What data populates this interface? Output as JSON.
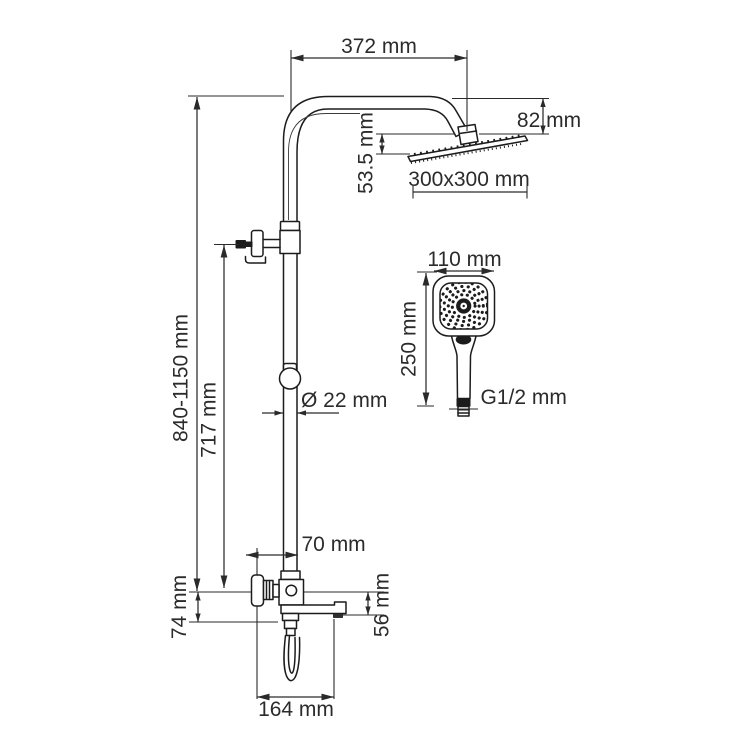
{
  "drawing": {
    "title": "Shower system technical drawing",
    "labels": {
      "arm_reach": "372 mm",
      "head_height": "82 mm",
      "head_offset": "53.5 mm",
      "head_size": "300x300 mm",
      "handshower_width": "110 mm",
      "handshower_length": "250 mm",
      "thread": "G1/2 mm",
      "column_height": "840-1150 mm",
      "holder_height": "717 mm",
      "pipe_diameter": "Ø 22 mm",
      "valve_offset": "70 mm",
      "spout_height_left": "74 mm",
      "spout_height_right": "56 mm",
      "spout_reach": "164 mm"
    },
    "colors": {
      "line": "#1c1c1c",
      "dimension": "#2a2a2a",
      "text": "#2b2b2b",
      "background": "#ffffff"
    }
  }
}
